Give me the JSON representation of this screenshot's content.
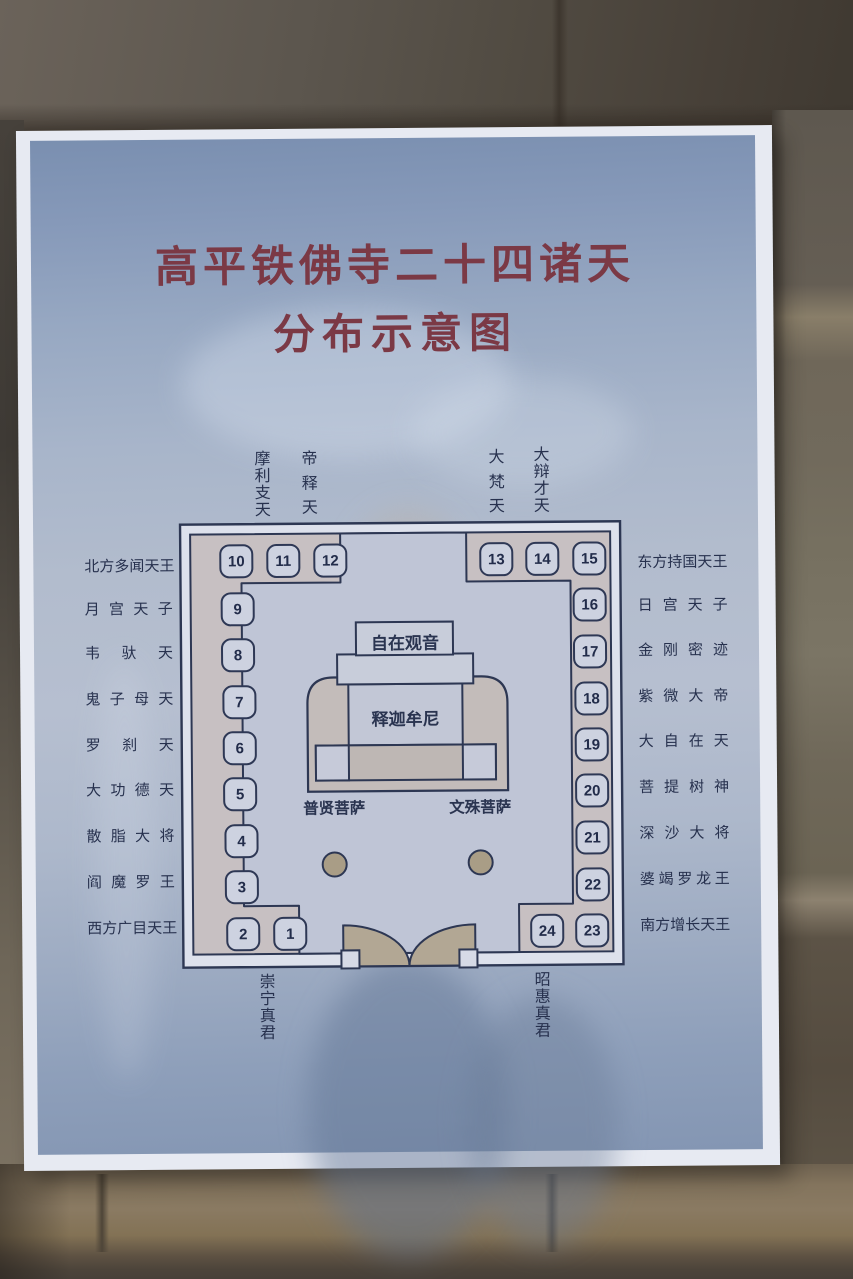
{
  "poster": {
    "title_line1": "高平铁佛寺二十四诸天",
    "title_line2": "分布示意图"
  },
  "diagram": {
    "numbers": [
      "1",
      "2",
      "3",
      "4",
      "5",
      "6",
      "7",
      "8",
      "9",
      "10",
      "11",
      "12",
      "13",
      "14",
      "15",
      "16",
      "17",
      "18",
      "19",
      "20",
      "21",
      "22",
      "23",
      "24"
    ],
    "left_labels": [
      "北方多闻天王",
      "月宫天子",
      "韦驮天",
      "鬼子母天",
      "罗刹天",
      "大功德天",
      "散脂大将",
      "阎魔罗王",
      "西方广目天王"
    ],
    "right_labels": [
      "东方持国天王",
      "日宫天子",
      "金刚密迹",
      "紫微大帝",
      "大自在天",
      "菩提树神",
      "深沙大将",
      "婆竭罗龙王",
      "南方增长天王"
    ],
    "top_labels": [
      "摩利支天",
      "帝释天",
      "大梵天",
      "大辩才天"
    ],
    "bottom_labels": [
      "崇宁真君",
      "昭惠真君"
    ],
    "center": {
      "guanyin": "自在观音",
      "sakyamuni": "释迦牟尼",
      "puxian": "普贤菩萨",
      "wenshu": "文殊菩萨"
    },
    "colors": {
      "title_red": "#7b3945",
      "line_navy": "#2d3753",
      "interior": "#bfc5d6",
      "wall_band": "#c7c0c2",
      "altar_tan": "#c3bcba",
      "pillar": "#a99d86"
    }
  }
}
